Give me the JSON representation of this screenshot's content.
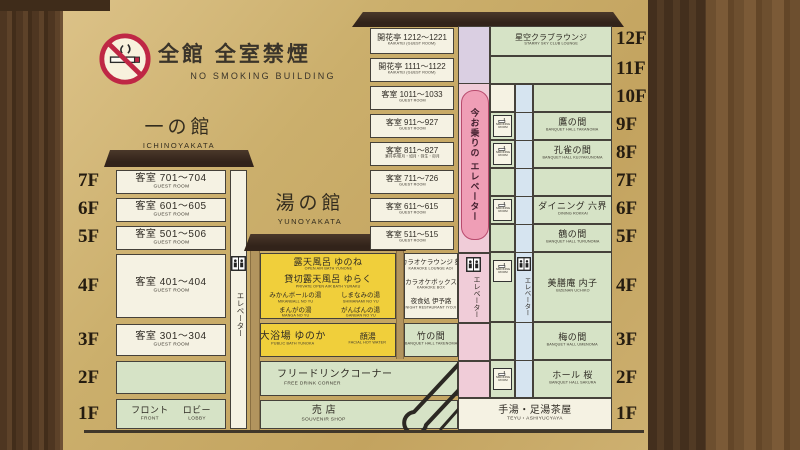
{
  "header": {
    "no_smoking_jp": "全館 全室禁煙",
    "no_smoking_en": "NO SMOKING BUILDING"
  },
  "left_labels": [
    "7F",
    "6F",
    "5F",
    "4F",
    "3F",
    "2F",
    "1F"
  ],
  "left_building": {
    "title_jp": "一の館",
    "title_en": "ICHINOYAKATA",
    "rooms": [
      {
        "jp": "客室 701～704",
        "en": "GUEST ROOM"
      },
      {
        "jp": "客室 601～605",
        "en": "GUEST ROOM"
      },
      {
        "jp": "客室 501～506",
        "en": "GUEST ROOM"
      },
      {
        "jp": "客室 401～404",
        "en": "GUEST ROOM"
      },
      {
        "jp": "客室 301～304",
        "en": "GUEST ROOM"
      }
    ],
    "lobby": {
      "front_jp": "フロント",
      "front_en": "FRONT",
      "lobby_jp": "ロビー",
      "lobby_en": "LOBBY"
    },
    "elevator_label": "エレベーター"
  },
  "middle_building": {
    "title_jp": "湯の館",
    "title_en": "YUNOYAKATA",
    "f4": {
      "line1_jp": "露天風呂 ゆのね",
      "line1_en": "OPEN AIR BATH YUNONE",
      "line2_jp": "貸切露天風呂 ゆらく",
      "line2_en": "PRIVATE OPEN AIR BATH YURAKU",
      "baths": [
        {
          "jp": "みかんボールの湯",
          "en": "MIKANBALL NO YU"
        },
        {
          "jp": "しまなみの湯",
          "en": "SHIMANAMI NO YU"
        },
        {
          "jp": "まんがの湯",
          "en": "MANGA NO YU"
        },
        {
          "jp": "がんばんの湯",
          "en": "GANBAN NO YU"
        }
      ]
    },
    "f3": {
      "jp": "大浴場 ゆのか",
      "en": "PUBLIC BATH YUNOKA",
      "sub_jp": "顔湯",
      "sub_en": "FACIAL HOT WATER"
    },
    "f2": {
      "jp": "フリードリンクコーナー",
      "en": "FREE DRINK CORNER"
    },
    "f1": {
      "jp": "売 店",
      "en": "SOUVENIR SHOP"
    }
  },
  "tower": {
    "floor_labels": [
      "12F",
      "11F",
      "10F",
      "9F",
      "8F",
      "7F",
      "6F",
      "5F",
      "4F",
      "3F",
      "2F",
      "1F"
    ],
    "rooms": [
      {
        "jp": "開花亭 1212～1221",
        "en": "KAIKATEI (GUEST ROOM)"
      },
      {
        "jp": "開花亭 1111～1122",
        "en": "KAIKATEI (GUEST ROOM)"
      },
      {
        "jp": "客室 1011～1033",
        "en": "GUEST ROOM"
      },
      {
        "jp": "客室 911～927",
        "en": "GUEST ROOM"
      },
      {
        "jp": "客室 811～827",
        "en": "",
        "sub": "湊月亭/睦月・如月・弥生・卯月"
      },
      {
        "jp": "客室 711～726",
        "en": "GUEST ROOM"
      },
      {
        "jp": "客室 611～615",
        "en": "GUEST ROOM"
      },
      {
        "jp": "客室 511～515",
        "en": "GUEST ROOM"
      }
    ],
    "karaoke": [
      {
        "jp": "カラオケラウンジ 葵",
        "en": "KARAOKE LOUNGE AOI"
      },
      {
        "jp": "カラオケボックス",
        "en": "KARAOKE BOX"
      },
      {
        "jp": "夜食処 伊予路",
        "en": "NIGHT RESTAURANT IYOJI"
      }
    ],
    "takenoma": {
      "jp": "竹の間",
      "en": "BANQUET HALL TAKENOMA"
    },
    "current_elevator": "今お乗りの エレベーター",
    "elevator_label": "エレベーター",
    "smoking_room": "SMOKING ROOM",
    "right_cells": [
      {
        "jp": "星空クラブラウンジ",
        "en": "STARRY SKY CLUB LOUNGE"
      },
      {
        "jp": "鷹の間",
        "en": "BANQUET HALL TAKANOMA"
      },
      {
        "jp": "孔雀の間",
        "en": "BANQUET HALL KUJYAKUNOMA"
      },
      {
        "jp": "ダイニング 六界",
        "en": "DINING ROKKAI"
      },
      {
        "jp": "鶴の間",
        "en": "BANQUET HALL TURUNOMA"
      },
      {
        "jp": "美膳庵 内子",
        "en": "BIZENAN UCHIKO"
      },
      {
        "jp": "梅の間",
        "en": "BANQUET HALL UMENOMA"
      },
      {
        "jp": "ホール 桜",
        "en": "BANQUET HALL SAKURA"
      },
      {
        "jp": "手湯・足湯茶屋",
        "en": "TEYU・ASHIYUCYAYA"
      }
    ]
  },
  "colors": {
    "sign_tan": "#cbaf6c",
    "cell_cream": "#f5f2e3",
    "cell_green": "#d6e3c6",
    "cell_yellow": "#f0cf3b",
    "pink_column": "#f0ccd8",
    "capsule_pink": "#ef9eb6",
    "blue_column": "#d6e4f0",
    "lavender": "#dacfe2",
    "frame_brown": "#4e3621",
    "roof_brown": "#32231a",
    "no_smoking_red": "#bf2745"
  }
}
